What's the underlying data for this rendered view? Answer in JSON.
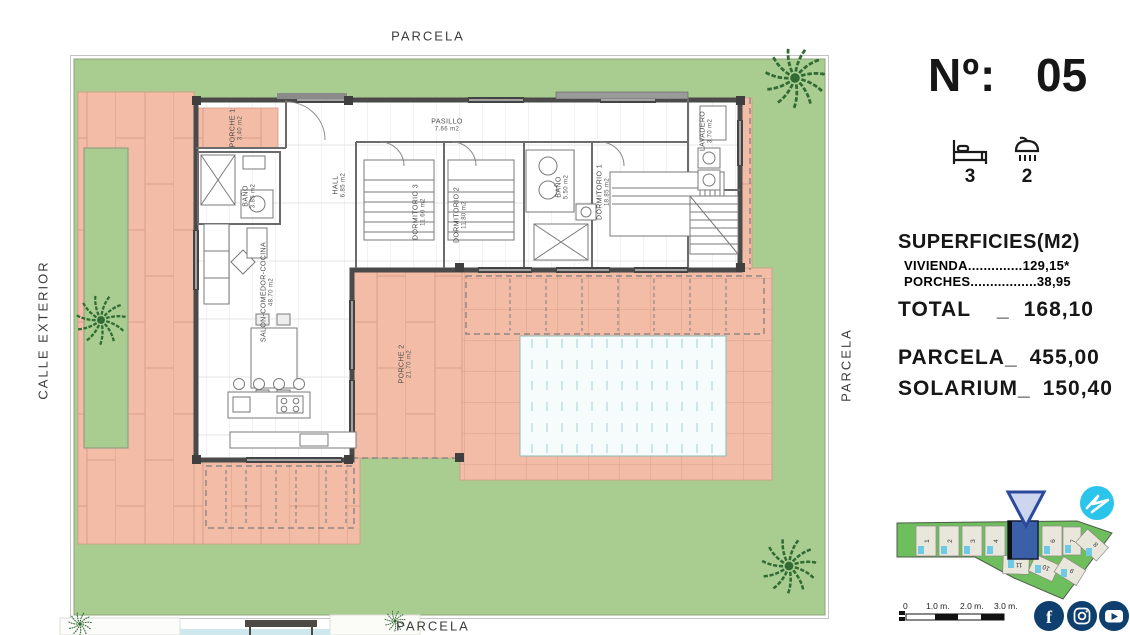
{
  "plan": {
    "labels": {
      "top": "PARCELA",
      "bottom": "PARCELA",
      "left": "CALLE EXTERIOR",
      "right": "PARCELA"
    },
    "rooms": {
      "porche1": {
        "name": "PORCHE 1",
        "area": "3.40 m2"
      },
      "bano1": {
        "name": "BAÑO",
        "area": "3.85 m2"
      },
      "hall": {
        "name": "HALL",
        "area": "6.85 m2"
      },
      "pasillo": {
        "name": "PASILLO",
        "area": "7.66 m2"
      },
      "dormitorio3": {
        "name": "DORMITORIO 3",
        "area": "11.60 m2"
      },
      "dormitorio2": {
        "name": "DORMITORIO 2",
        "area": "11.80 m2"
      },
      "bano2": {
        "name": "BAÑO",
        "area": "5.50 m2"
      },
      "dormitorio1": {
        "name": "DORMITORIO 1",
        "area": "18.85 m2"
      },
      "lavadero": {
        "name": "LAVADERO",
        "area": "3.70 m2"
      },
      "salon": {
        "name": "SALON-COMEDOR-COCINA",
        "area": "48.70 m2"
      },
      "porche2": {
        "name": "PORCHE 2",
        "area": "21.70 m2"
      }
    }
  },
  "info": {
    "number_label": "Nº:",
    "number": "05",
    "bedrooms": "3",
    "bathrooms": "2",
    "superficies_title": "SUPERFICIES(M2)",
    "vivienda_label": "VIVIENDA",
    "vivienda_dots": "..............",
    "vivienda_value": "129,15*",
    "porches_label": "PORCHES",
    "porches_dots": ".................",
    "porches_value": "38,95",
    "total_label": "TOTAL",
    "total_sep": "_",
    "total_value": "168,10",
    "parcela_label": "PARCELA_",
    "parcela_value": "455,00",
    "solarium_label": "SOLARIUM_",
    "solarium_value": "150,40"
  },
  "siteplan": {
    "plots": [
      "1",
      "2",
      "3",
      "4",
      "5",
      "6",
      "7",
      "8",
      "9",
      "10",
      "11"
    ],
    "highlighted": "5",
    "scale": [
      "0",
      "1.0 m.",
      "2.0 m.",
      "3.0 m."
    ]
  },
  "social": [
    "facebook",
    "instagram",
    "youtube"
  ],
  "colors": {
    "grass": "#a9cc90",
    "tile": "#f3bca7",
    "tile_line": "#d89e89",
    "pool": "#f6fbfb",
    "wall": "#4a4a4a",
    "plot_highlight": "#3b5fa8",
    "map_green": "#6fbe5e",
    "brand_cyan": "#2bc4ea",
    "social_navy": "#0e3f6e",
    "palm_green": "#2f6b33"
  }
}
